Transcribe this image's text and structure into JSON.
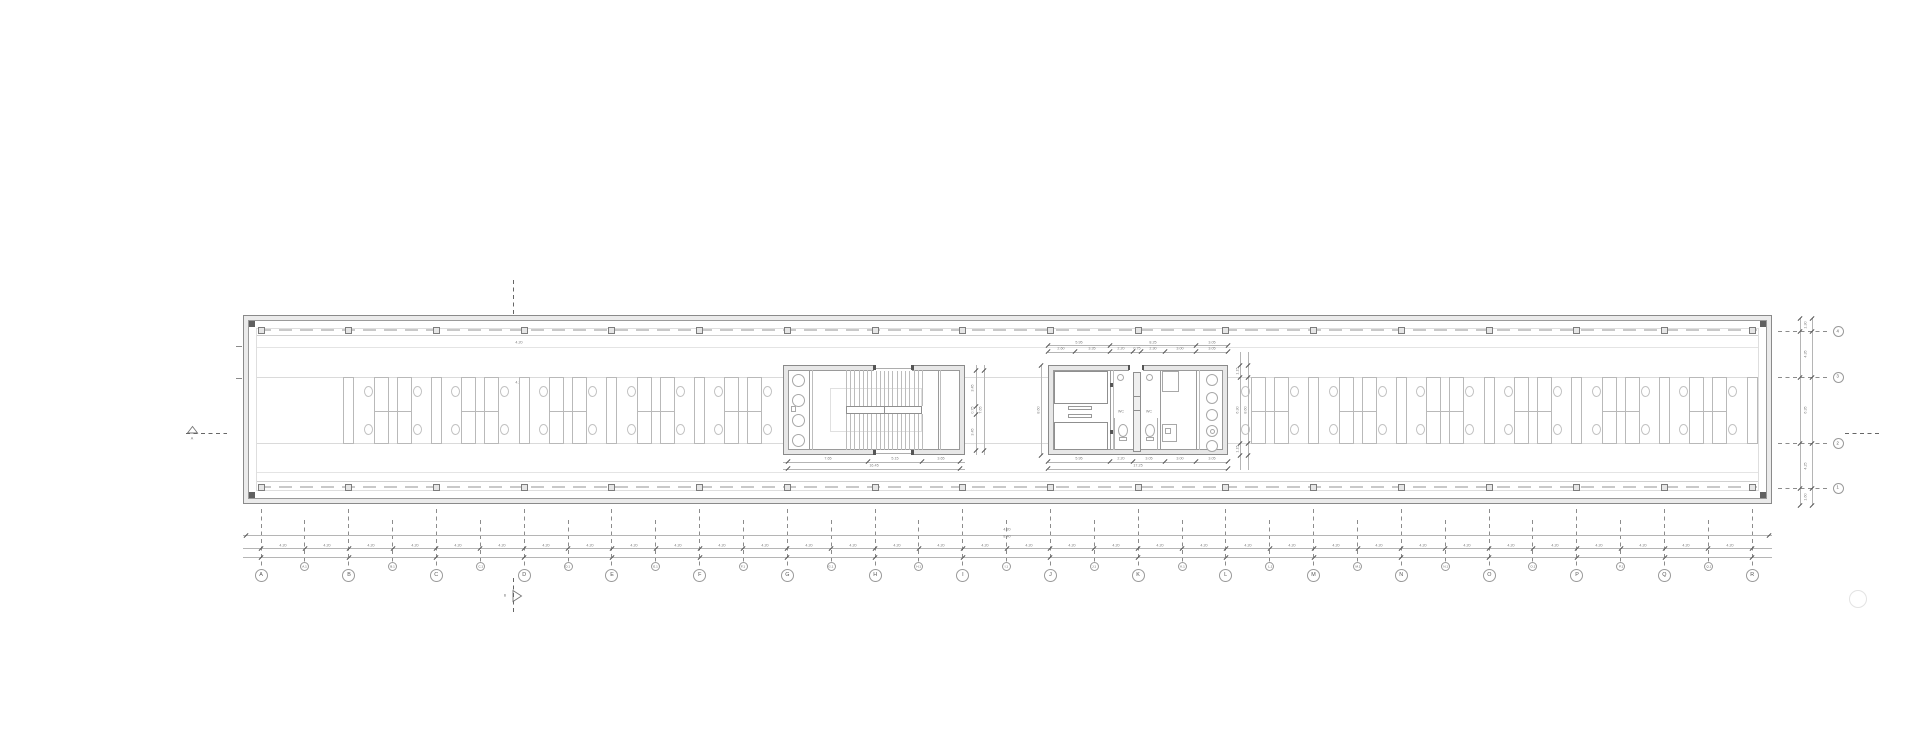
{
  "grid": {
    "major_labels": [
      "A",
      "B",
      "C",
      "D",
      "E",
      "F",
      "G",
      "H",
      "I",
      "J",
      "K",
      "L",
      "M",
      "N",
      "O",
      "P",
      "Q",
      "R"
    ],
    "minor_labels": [
      "A.1",
      "B.1",
      "C.1",
      "D.1",
      "E.1",
      "F.1",
      "G.1",
      "H.1",
      "I.1",
      "J.1",
      "K.1",
      "L.1",
      "M.1",
      "N.1",
      "O.1",
      "P.1",
      "Q.1"
    ],
    "row_labels": [
      "4",
      "3",
      "2",
      "1"
    ],
    "half_bay_dim_label": "4.20",
    "level_mark_labels": [
      "4.20",
      "8.40"
    ]
  },
  "section_markers": {
    "horizontal_label": "A",
    "vertical_label": "B"
  },
  "dimensions": {
    "right_edge_vertical": [
      "1.30",
      "4.35",
      "6.35",
      "4.25",
      "1.60"
    ],
    "stair_core_row1": [
      "7.65",
      "5.15",
      "3.65"
    ],
    "stair_core_row2": [
      "16.45"
    ],
    "stair_core_side": [
      "3.45",
      "0.75",
      "3.45"
    ],
    "stair_core_side_overall": [
      "7.65"
    ],
    "service_core_top_row1": [
      "5.95",
      "8.25",
      "3.05"
    ],
    "service_core_top_row2": [
      "2.60",
      "3.35",
      "2.20",
      "0.75",
      "2.30",
      "3.00",
      "3.05"
    ],
    "service_core_bottom_row1": [
      "5.95",
      "2.20",
      "3.05",
      "3.00",
      "3.05"
    ],
    "service_core_bottom_row2": [
      "17.25"
    ],
    "service_core_right": [
      "1.15",
      "6.30",
      "1.15"
    ],
    "service_core_right_overall": "8.60",
    "service_core_left_overall": "8.60",
    "wall_level_marks": [
      "4.20",
      "4.20"
    ]
  },
  "labels": {
    "wc_1": "WC",
    "wc_2": "WC"
  },
  "colors": {
    "wall_line": "#8a8a8a",
    "wall_fill": "#ebebeb",
    "furniture": "#b9b9b9",
    "dim_line": "#b5b5b5",
    "dim_tick": "#555555",
    "grid_dash": "#8c8c8c",
    "section_dash": "#666666",
    "faint": "#e4e4e4"
  }
}
